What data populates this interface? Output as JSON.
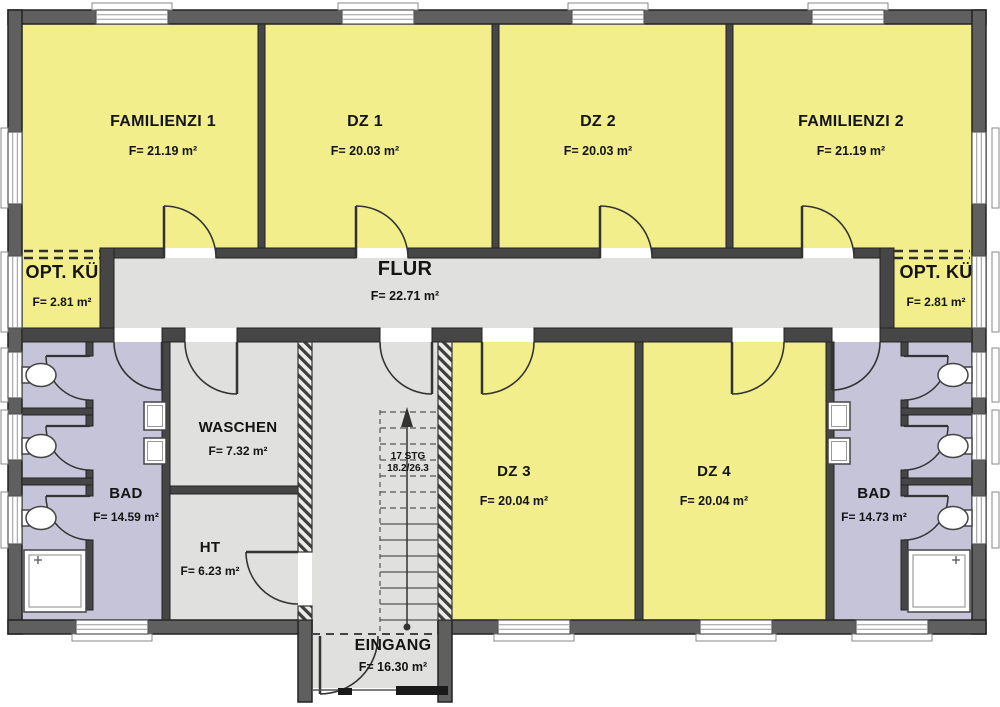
{
  "rooms": [
    {
      "name": "FAMILIENZI 1",
      "area": "F= 21.19 m²"
    },
    {
      "name": "DZ 1",
      "area": "F= 20.03 m²"
    },
    {
      "name": "DZ 2",
      "area": "F= 20.03 m²"
    },
    {
      "name": "FAMILIENZI 2",
      "area": "F= 21.19 m²"
    },
    {
      "name": "OPT. KÜ",
      "area": "F= 2.81 m²"
    },
    {
      "name": "FLUR",
      "area": "F= 22.71 m²"
    },
    {
      "name": "OPT. KÜ",
      "area": "F= 2.81 m²"
    },
    {
      "name": "WASCHEN",
      "area": "F= 7.32 m²"
    },
    {
      "name": "HT",
      "area": "F= 6.23 m²"
    },
    {
      "name": "DZ 3",
      "area": "F= 20.04 m²"
    },
    {
      "name": "DZ 4",
      "area": "F= 20.04 m²"
    },
    {
      "name": "BAD",
      "area": "F= 14.59 m²"
    },
    {
      "name": "BAD",
      "area": "F= 14.73 m²"
    },
    {
      "name": "EINGANG",
      "area": "F= 16.30 m²"
    }
  ],
  "staircase": {
    "steps": "17 STG",
    "riser_tread": "18.2/26.3"
  },
  "colors": {
    "bedroom_yellow": "#f3ee8c",
    "service_gray": "#e0e0de",
    "bathroom_lavender": "#c6c4d9",
    "wall_gray": "#5f5f5f"
  }
}
